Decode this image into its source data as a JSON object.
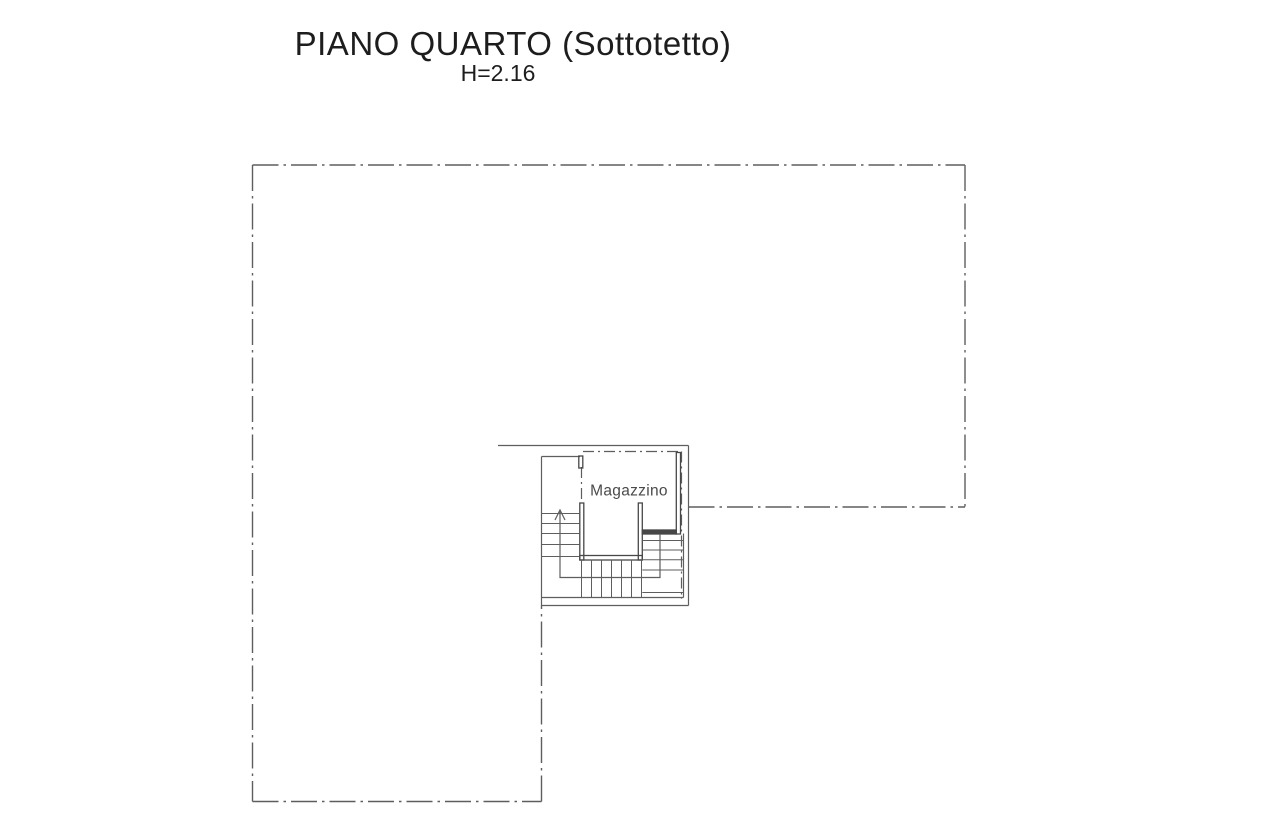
{
  "header": {
    "title": "PIANO QUARTO (Sottotetto)",
    "subtitle": "H=2.16"
  },
  "plan": {
    "room_label": "Magazzino"
  },
  "colors": {
    "background": "#ffffff",
    "line": "#5e5e5e",
    "wall": "#474747",
    "text": "#1d1d1d",
    "room_text": "#4a4a4a"
  }
}
